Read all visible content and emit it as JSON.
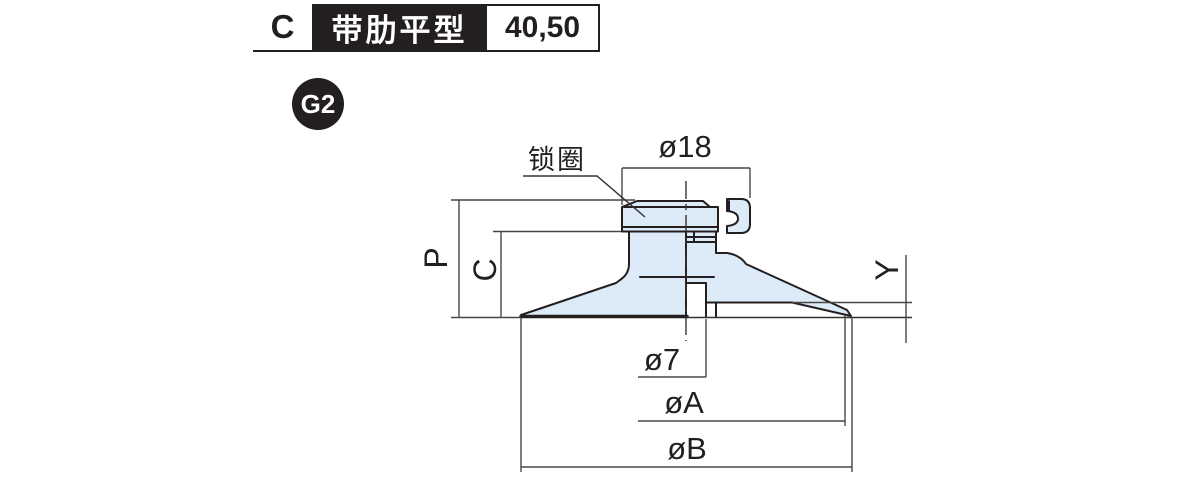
{
  "header": {
    "code": "C",
    "type_name": "带肋平型",
    "sizes": "40,50"
  },
  "badge": {
    "label": "G2"
  },
  "drawing": {
    "labels": {
      "lock_ring": "锁圈",
      "fitting_diameter": "ø18",
      "total_height": "P",
      "body_height": "C",
      "lip_height": "Y",
      "bore_diameter": "ø7",
      "pad_inner_diameter": "øA",
      "pad_outer_diameter": "øB"
    },
    "colors": {
      "line": "#231f20",
      "dim_line": "#4a4645",
      "part_fill": "#dcebf7",
      "background": "#ffffff"
    }
  }
}
